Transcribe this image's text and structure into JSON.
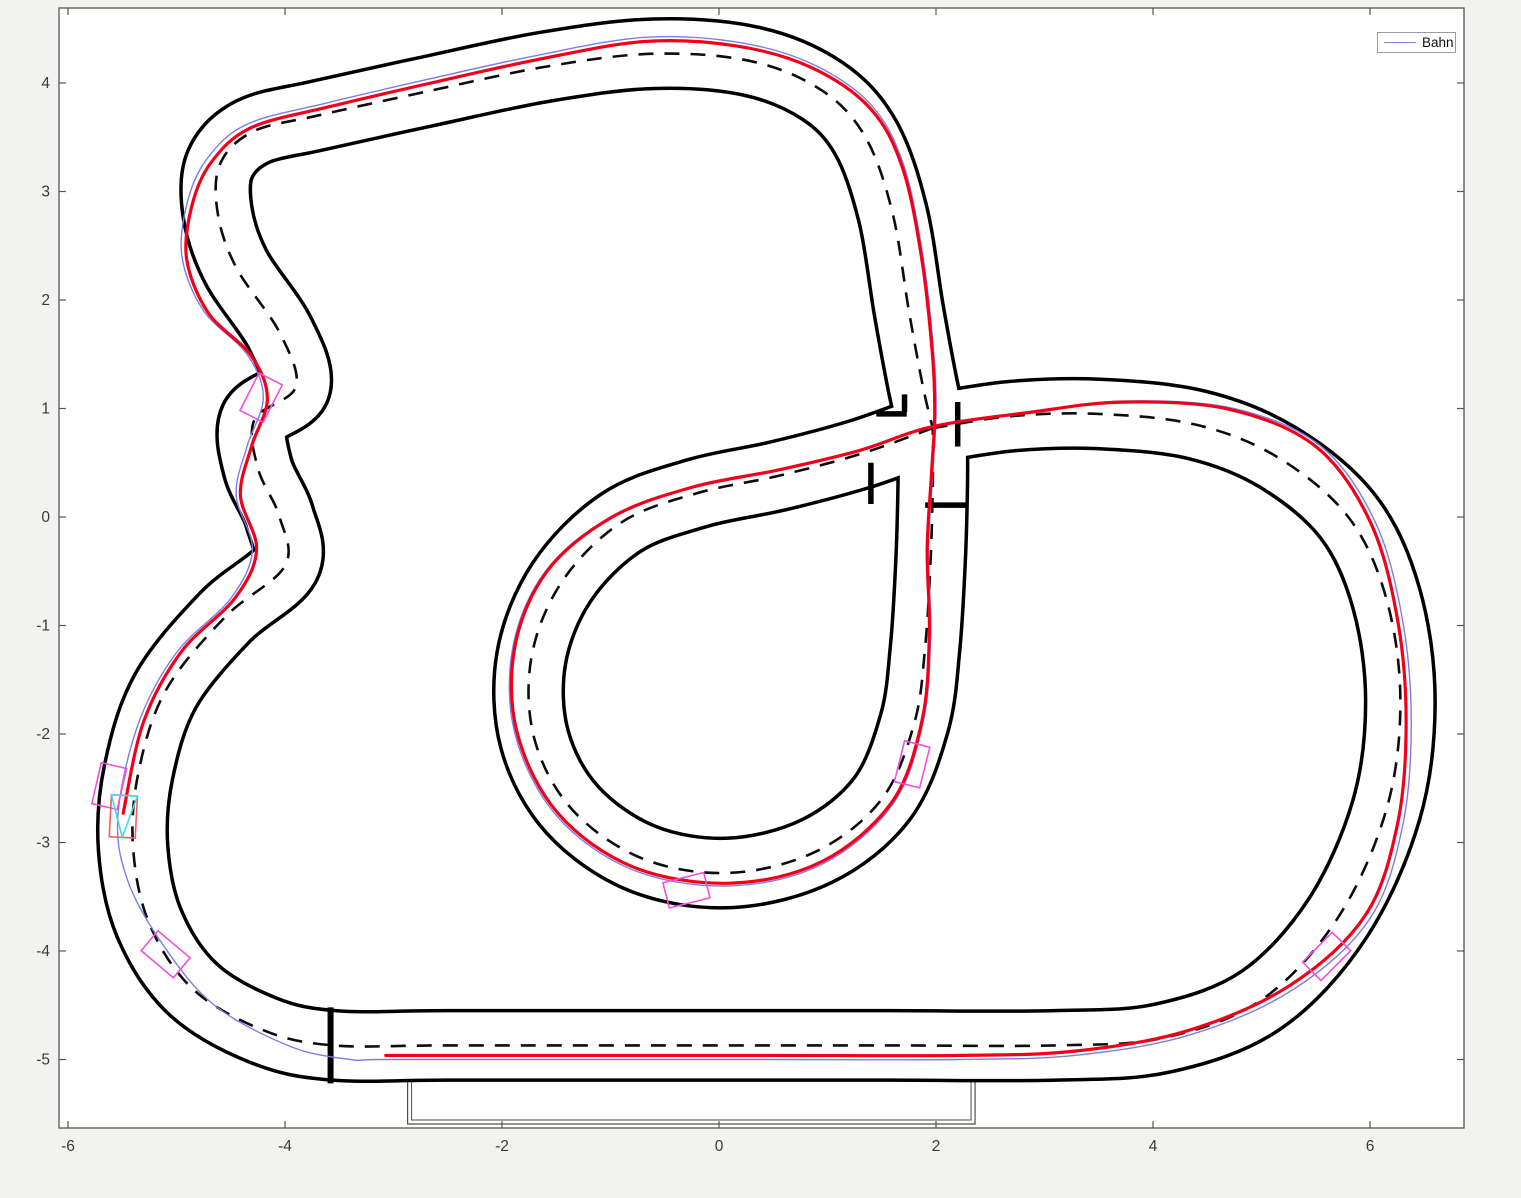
{
  "window": {
    "background": "#f2f2f0"
  },
  "legend": {
    "label": "Bahn",
    "line_color": "#7d7ce8"
  },
  "chart_data": {
    "type": "line",
    "title": "",
    "xlabel": "",
    "ylabel": "",
    "grid": false,
    "legend_entries": [
      "Bahn"
    ],
    "legend_position": "northeast",
    "xlim": [
      -6.08,
      6.87
    ],
    "ylim": [
      -5.63,
      4.69
    ],
    "x_ticks": [
      -6,
      -4,
      -2,
      0,
      2,
      4,
      6
    ],
    "y_ticks": [
      4,
      3,
      2,
      1,
      0,
      -1,
      -2,
      -3,
      -4,
      -5
    ],
    "equal_aspect": true,
    "layout": {
      "width": 1521,
      "height": 1198,
      "plot_left": 59,
      "plot_top": 8,
      "plot_right": 1464,
      "plot_bottom": 1128,
      "x0_px": 719,
      "y0_px": 517,
      "px_per_unit": 108.5,
      "tick_len": 7,
      "tick_font_px": 15.5,
      "x_label_y": 1151,
      "y_label_x": 50
    },
    "style": {
      "plot_bg": "#ffffff",
      "axis_color": "#555555",
      "tick_color": "#3a3a3a",
      "track_edge_color": "#000000",
      "track_lane_color": "#ffffff",
      "track_stroke_px": 73,
      "lane_stroke_px": 66,
      "dash_color": "#0d0d0d",
      "dash_width": 2.6,
      "dash_array": "15 11",
      "bar_color": "#000000",
      "bar_width": 5.5,
      "race_line_color": "#7d7ce8",
      "race_line_width": 1.4,
      "trajectory_color": "#f20019",
      "trajectory_width": 3.2,
      "car_color": "#f24fe0",
      "ego_color": "#f25f5f",
      "ego_heading_color": "#3adede",
      "pit_box_color": "#4a4a4a"
    },
    "track": {
      "lane_width_units": 0.67,
      "segments": [
        {
          "name": "outer-circuit",
          "closed": false,
          "points": [
            [
              1.97,
              0.82
            ],
            [
              2.7,
              0.93
            ],
            [
              3.5,
              0.95
            ],
            [
              4.4,
              0.85
            ],
            [
              5.15,
              0.55
            ],
            [
              5.8,
              0.0
            ],
            [
              6.15,
              -0.75
            ],
            [
              6.28,
              -1.7
            ],
            [
              6.15,
              -2.7
            ],
            [
              5.7,
              -3.7
            ],
            [
              5.0,
              -4.45
            ],
            [
              4.1,
              -4.8
            ],
            [
              3.1,
              -4.87
            ],
            [
              1.5,
              -4.87
            ],
            [
              -0.5,
              -4.87
            ],
            [
              -2.5,
              -4.87
            ],
            [
              -3.55,
              -4.87
            ],
            [
              -4.2,
              -4.73
            ],
            [
              -4.85,
              -4.35
            ],
            [
              -5.25,
              -3.75
            ],
            [
              -5.4,
              -3.05
            ],
            [
              -5.35,
              -2.35
            ],
            [
              -5.1,
              -1.6
            ],
            [
              -4.55,
              -0.92
            ],
            [
              -4.0,
              -0.45
            ],
            [
              -4.05,
              0.0
            ],
            [
              -4.25,
              0.45
            ],
            [
              -4.28,
              0.9
            ],
            [
              -3.9,
              1.2
            ],
            [
              -4.05,
              1.7
            ],
            [
              -4.45,
              2.3
            ],
            [
              -4.62,
              2.8
            ],
            [
              -4.6,
              3.25
            ],
            [
              -4.3,
              3.55
            ],
            [
              -3.7,
              3.7
            ],
            [
              -2.7,
              3.92
            ],
            [
              -1.6,
              4.15
            ],
            [
              -0.6,
              4.27
            ],
            [
              0.3,
              4.2
            ],
            [
              0.95,
              3.93
            ],
            [
              1.35,
              3.5
            ],
            [
              1.6,
              2.8
            ],
            [
              1.75,
              1.9
            ],
            [
              1.88,
              1.2
            ],
            [
              1.97,
              0.82
            ]
          ]
        },
        {
          "name": "center-loop",
          "closed": false,
          "points": [
            [
              1.97,
              0.82
            ],
            [
              1.3,
              0.58
            ],
            [
              0.55,
              0.38
            ],
            [
              -0.2,
              0.22
            ],
            [
              -0.9,
              -0.05
            ],
            [
              -1.45,
              -0.6
            ],
            [
              -1.73,
              -1.3
            ],
            [
              -1.7,
              -2.05
            ],
            [
              -1.35,
              -2.7
            ],
            [
              -0.7,
              -3.15
            ],
            [
              0.1,
              -3.28
            ],
            [
              0.9,
              -3.08
            ],
            [
              1.5,
              -2.6
            ],
            [
              1.8,
              -1.9
            ],
            [
              1.9,
              -1.2
            ],
            [
              1.95,
              -0.4
            ],
            [
              1.97,
              0.3
            ],
            [
              1.97,
              0.82
            ]
          ]
        }
      ],
      "joint_bars": [
        [
          [
            1.45,
            0.95
          ],
          [
            1.73,
            0.95
          ]
        ],
        [
          [
            2.2,
            0.65
          ],
          [
            2.2,
            1.06
          ]
        ],
        [
          [
            1.9,
            0.11
          ],
          [
            2.28,
            0.11
          ]
        ],
        [
          [
            1.4,
            0.12
          ],
          [
            1.4,
            0.5
          ]
        ],
        [
          [
            1.71,
            0.97
          ],
          [
            1.71,
            1.13
          ]
        ]
      ],
      "start_line": [
        [
          -3.58,
          -4.52
        ],
        [
          -3.58,
          -5.22
        ]
      ],
      "pit_box": {
        "x_units": [
          -2.87,
          2.36
        ],
        "y_px": [
          1076,
          1124
        ],
        "inset": 4
      }
    },
    "race_line": {
      "closed": true,
      "points": [
        [
          -3.1,
          -5.0
        ],
        [
          -1.5,
          -5.0
        ],
        [
          0.5,
          -5.0
        ],
        [
          2.2,
          -5.0
        ],
        [
          3.3,
          -4.96
        ],
        [
          4.35,
          -4.77
        ],
        [
          5.3,
          -4.35
        ],
        [
          6.0,
          -3.7
        ],
        [
          6.3,
          -2.85
        ],
        [
          6.38,
          -1.9
        ],
        [
          6.3,
          -0.95
        ],
        [
          6.05,
          -0.05
        ],
        [
          5.55,
          0.65
        ],
        [
          4.75,
          1.0
        ],
        [
          3.75,
          1.07
        ],
        [
          2.85,
          0.97
        ],
        [
          1.97,
          0.84
        ],
        [
          1.3,
          0.62
        ],
        [
          0.55,
          0.44
        ],
        [
          -0.25,
          0.28
        ],
        [
          -1.0,
          0.0
        ],
        [
          -1.6,
          -0.5
        ],
        [
          -1.9,
          -1.2
        ],
        [
          -1.88,
          -2.0
        ],
        [
          -1.5,
          -2.75
        ],
        [
          -0.8,
          -3.25
        ],
        [
          0.1,
          -3.4
        ],
        [
          0.95,
          -3.2
        ],
        [
          1.6,
          -2.65
        ],
        [
          1.88,
          -1.9
        ],
        [
          1.95,
          -1.1
        ],
        [
          1.93,
          -0.3
        ],
        [
          1.97,
          0.4
        ],
        [
          2.0,
          0.95
        ],
        [
          1.98,
          1.5
        ],
        [
          1.88,
          2.4
        ],
        [
          1.7,
          3.25
        ],
        [
          1.4,
          3.8
        ],
        [
          0.85,
          4.18
        ],
        [
          0.15,
          4.38
        ],
        [
          -0.7,
          4.42
        ],
        [
          -1.7,
          4.25
        ],
        [
          -2.7,
          4.03
        ],
        [
          -3.6,
          3.82
        ],
        [
          -4.35,
          3.62
        ],
        [
          -4.72,
          3.3
        ],
        [
          -4.9,
          2.9
        ],
        [
          -4.95,
          2.4
        ],
        [
          -4.75,
          1.9
        ],
        [
          -4.35,
          1.5
        ],
        [
          -4.2,
          1.1
        ],
        [
          -4.35,
          0.65
        ],
        [
          -4.45,
          0.2
        ],
        [
          -4.3,
          -0.3
        ],
        [
          -4.5,
          -0.75
        ],
        [
          -5.0,
          -1.25
        ],
        [
          -5.35,
          -1.9
        ],
        [
          -5.54,
          -2.75
        ],
        [
          -5.45,
          -3.35
        ],
        [
          -5.12,
          -3.95
        ],
        [
          -4.65,
          -4.5
        ],
        [
          -3.95,
          -4.88
        ],
        [
          -3.4,
          -5.0
        ]
      ]
    },
    "trajectory": {
      "start_index": 0,
      "end_index": 57,
      "shrink": 0.992,
      "shrink_center": [
        0.5,
        -0.3
      ]
    },
    "cars": [
      {
        "x": -4.22,
        "y": 1.1,
        "bearing": 207,
        "kind": "marker"
      },
      {
        "x": -5.62,
        "y": -2.48,
        "bearing": 193,
        "kind": "marker"
      },
      {
        "x": -5.49,
        "y": -2.76,
        "bearing": 183,
        "kind": "ego"
      },
      {
        "x": -5.1,
        "y": -4.03,
        "bearing": 130,
        "kind": "marker"
      },
      {
        "x": -0.3,
        "y": -3.44,
        "bearing": 76,
        "kind": "marker"
      },
      {
        "x": 1.78,
        "y": -2.28,
        "bearing": 14,
        "kind": "marker"
      },
      {
        "x": 5.6,
        "y": -4.05,
        "bearing": 45,
        "kind": "marker"
      }
    ],
    "car_size": {
      "width_px": 26,
      "length_px": 42
    }
  }
}
